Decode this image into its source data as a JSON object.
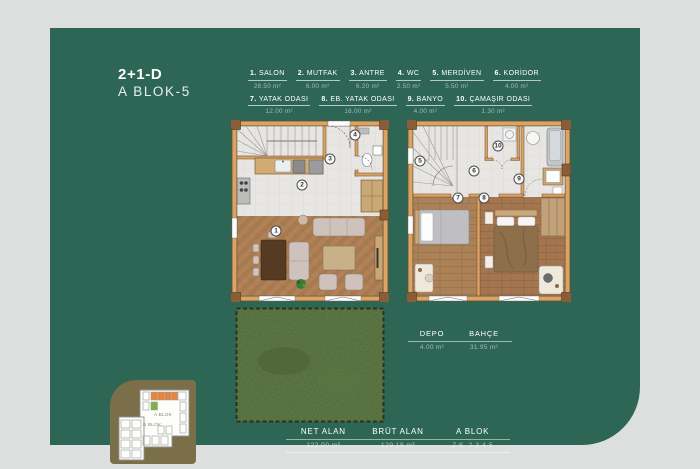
{
  "title": {
    "line1": "2+1-D",
    "line2": "A BLOK-5"
  },
  "rooms": [
    {
      "num": "1",
      "num_label": "1.",
      "name": "SALON",
      "area": "28.50 m²"
    },
    {
      "num": "2",
      "num_label": "2.",
      "name": "MUTFAK",
      "area": "6.00 m²"
    },
    {
      "num": "3",
      "num_label": "3.",
      "name": "ANTRE",
      "area": "6.20 m²"
    },
    {
      "num": "4",
      "num_label": "4.",
      "name": "WC",
      "area": "2.50 m²"
    },
    {
      "num": "5",
      "num_label": "5.",
      "name": "MERDİVEN",
      "area": "5.50 m²"
    },
    {
      "num": "6",
      "num_label": "6.",
      "name": "KORİDOR",
      "area": "4.00 m²"
    },
    {
      "num": "7",
      "num_label": "7.",
      "name": "YATAK ODASI",
      "area": "12.00 m²"
    },
    {
      "num": "8",
      "num_label": "8.",
      "name": "EB. YATAK ODASI",
      "area": "16.00 m²"
    },
    {
      "num": "9",
      "num_label": "9.",
      "name": "BANYO",
      "area": "4.00 m²"
    },
    {
      "num": "10",
      "num_label": "10.",
      "name": "ÇAMAŞIR ODASI",
      "area": "1.30 m²"
    }
  ],
  "extras": {
    "depo_label": "DEPO",
    "depo_area": "4.00 m²",
    "bahce_label": "BAHÇE",
    "bahce_area": "31.95 m²"
  },
  "summary": {
    "net_label": "NET ALAN",
    "net_value": "122.00 m²",
    "brut_label": "BRÜT ALAN",
    "brut_value": "129.18 m²",
    "blok_label": "A BLOK",
    "blok_value": "Z.K. 2-3-4-5"
  },
  "minimap": {
    "a_label": "A BLOK",
    "b_label": "B BLOK"
  },
  "colors": {
    "card_green": "#2d6655",
    "page_bg": "#dcdfdd",
    "minimap_bg": "#7b6f4a",
    "unit_highlight": "#e8833a",
    "unit_selected": "#7cb342"
  }
}
